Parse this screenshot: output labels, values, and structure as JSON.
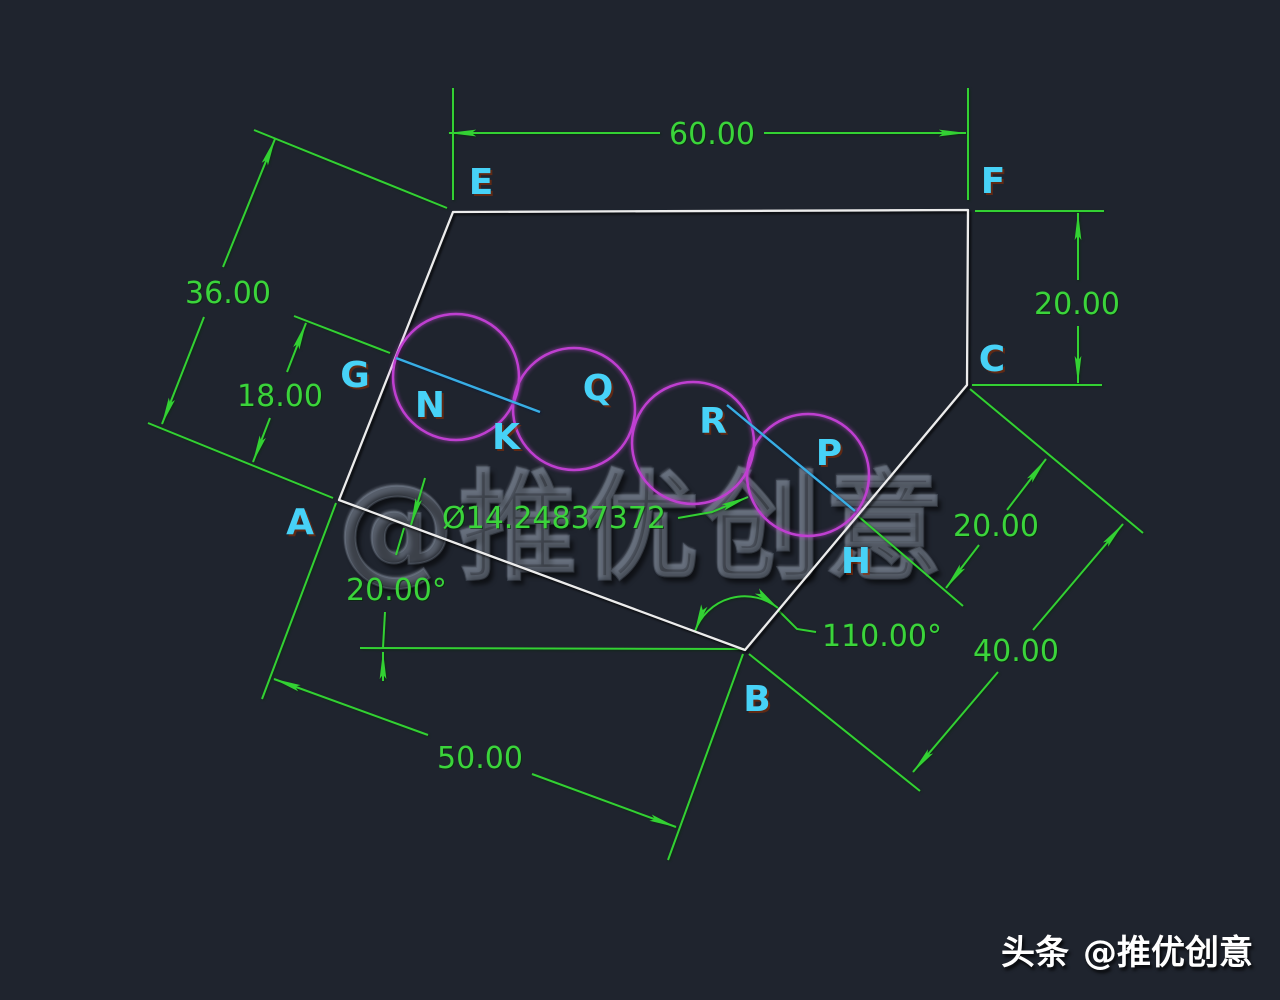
{
  "colors": {
    "background": "#1f242e",
    "dimension_green": "#33d133",
    "label_cyan": "#47d2f7",
    "construction_cyan": "#38aee4",
    "circle_magenta": "#bf3fd0",
    "outline_white": "#ececec"
  },
  "labels": {
    "E": "E",
    "F": "F",
    "C": "C",
    "G": "G",
    "A": "A",
    "B": "B",
    "H": "H",
    "N": "N",
    "K": "K",
    "Q": "Q",
    "R": "R",
    "P": "P"
  },
  "dims": {
    "top_width": "60.00",
    "left_total": "36.00",
    "left_partial": "18.00",
    "right_height": "20.00",
    "ch_offset": "20.00",
    "cb_length": "40.00",
    "bottom_width": "50.00",
    "angle_a": "20.00°",
    "angle_b": "110.00°",
    "diameter": "Ø14.24837372"
  },
  "watermark": {
    "text": "@推优创意"
  },
  "credit": {
    "brand": "头条",
    "handle": "@推优创意"
  }
}
